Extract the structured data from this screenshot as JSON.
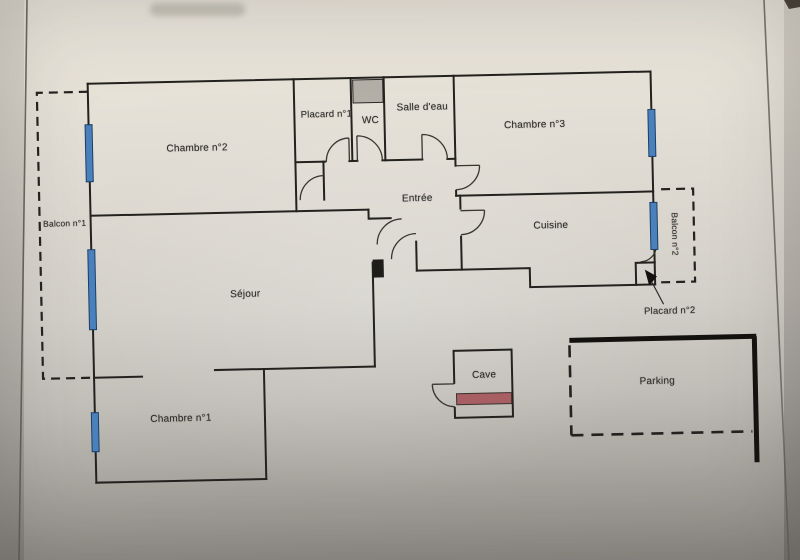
{
  "labels": {
    "chambre2": "Chambre n°2",
    "placard1": "Placard n°1",
    "wc": "WC",
    "salle_deau": "Salle d'eau",
    "chambre3": "Chambre n°3",
    "entree": "Entrée",
    "cuisine": "Cuisine",
    "sejour": "Séjour",
    "chambre1": "Chambre n°1",
    "balcon1": "Balcon n°1",
    "balcon2": "Balcon n°2",
    "placard2": "Placard n°2",
    "cave": "Cave",
    "parking": "Parking"
  },
  "colors": {
    "wall": "#23221f",
    "window_fill": "#4a81bd",
    "window_border": "#1b3f66",
    "shaft_gray": "#b3afa7",
    "cave_bar": "#a85f63",
    "notch_black": "#1e1d1a",
    "paper_light": "#e9e5db",
    "paper_dark": "#8b8882"
  }
}
